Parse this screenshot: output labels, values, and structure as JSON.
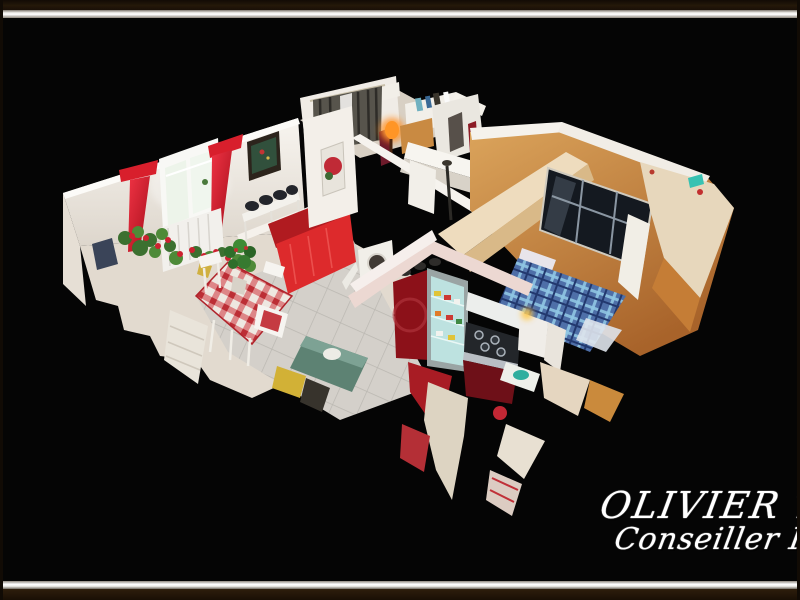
{
  "scene": {
    "description": "Cutaway 3D dollhouse scan of a furnished apartment viewed from above, floating on a black background inside a picture frame",
    "rooms": [
      {
        "label": "Living room with red curtains, bright window, dark framed painting and red sofa"
      },
      {
        "label": "Dining area with red gingham tablecloth, potted plant and white chairs"
      },
      {
        "label": "Kitchen with dark red cabinets, glass-front fridge and gas hob"
      },
      {
        "label": "Back room with dark grey curtains, glowing orange lamp and display shelf"
      },
      {
        "label": "Bedroom with orange walls, mirrored wardrobe and blue tartan bed"
      }
    ]
  },
  "signature": {
    "line1": "OLIVIER TIRA",
    "line2": "Conseiller Immo"
  },
  "frame": {
    "outer": "#1c1209",
    "band": "#f0efeb"
  },
  "palette": {
    "background": "#050505",
    "wall_white": "#f2efe9",
    "curtain_red": "#d81f2c",
    "sofa_red": "#dd2a2c",
    "gingham_red": "#d0333a",
    "cabinet_red": "#8c1119",
    "bedroom_orange": "#cf9049",
    "plaid_blue": "#4e6fa8",
    "lamp_orange": "#ff9526",
    "teal_accent": "#38c2b2"
  }
}
